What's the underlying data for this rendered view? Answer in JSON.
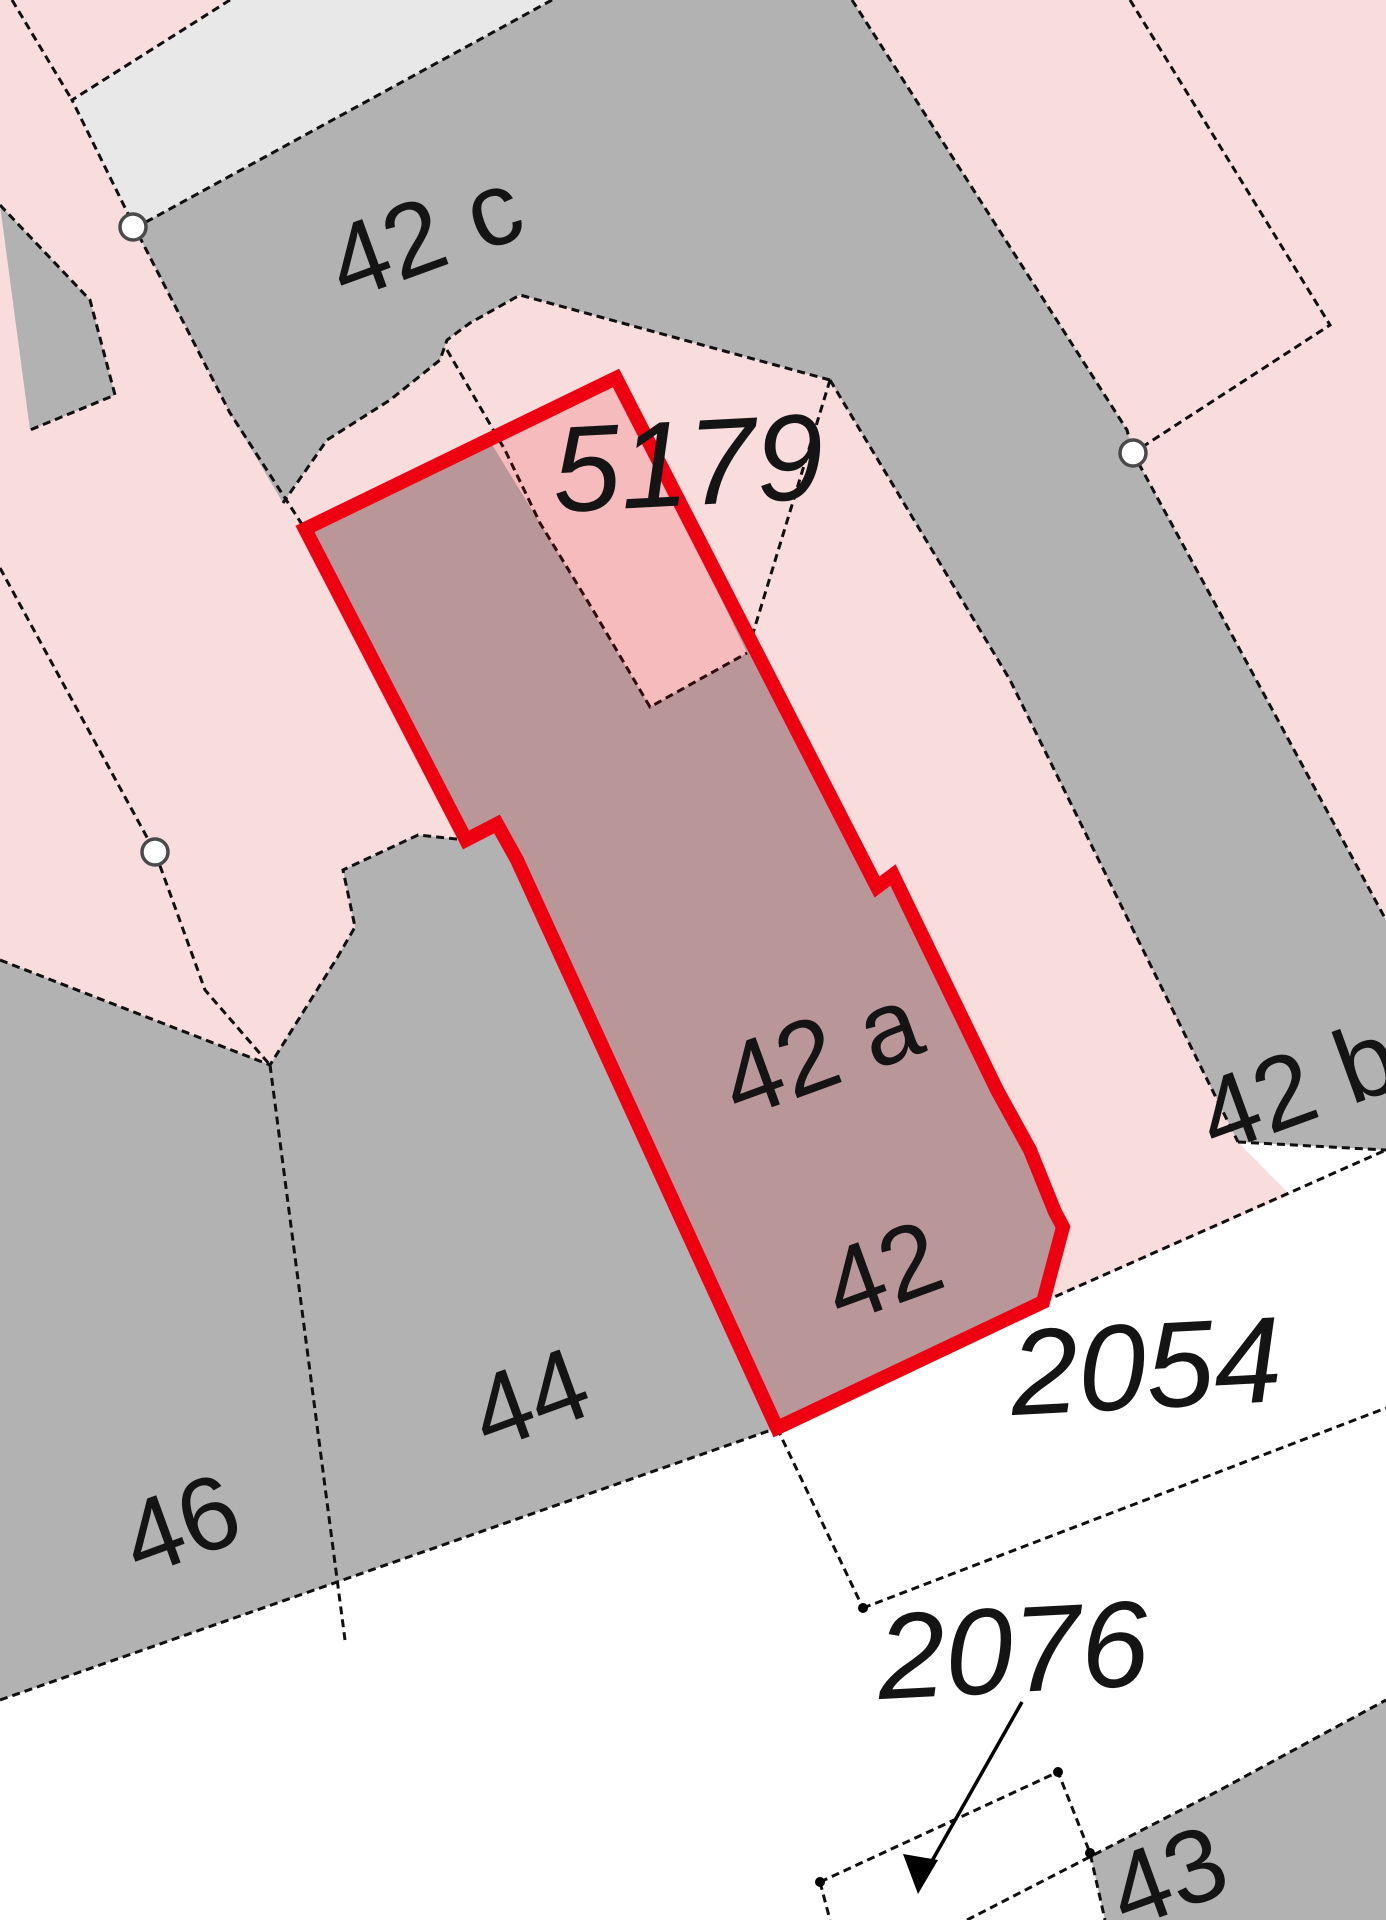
{
  "map": {
    "description": "cadastral parcel map with highlighted parcel",
    "colors": {
      "parcel_pink": "#f9dcdc",
      "building_gray": "#b2b2b2",
      "street_white": "#ffffff",
      "light_gray_area": "#e8e8e8",
      "highlight_red_stroke": "#ee0011",
      "highlight_red_fill": "rgba(230,0,15,0.15)",
      "boundary_black": "#101010"
    },
    "highlight": {
      "house_labels_inside": [
        "42 a",
        "42"
      ],
      "selected": true
    }
  },
  "labels": [
    {
      "id": "house-42c",
      "text": "42 c"
    },
    {
      "id": "parcel-5179",
      "text": "5179"
    },
    {
      "id": "house-42a",
      "text": "42 a"
    },
    {
      "id": "house-42",
      "text": "42"
    },
    {
      "id": "house-42b",
      "text": "42 b"
    },
    {
      "id": "house-44",
      "text": "44"
    },
    {
      "id": "house-46",
      "text": "46"
    },
    {
      "id": "parcel-2054",
      "text": "2054"
    },
    {
      "id": "parcel-2076",
      "text": "2076"
    },
    {
      "id": "house-43",
      "text": "43"
    }
  ],
  "boundary_circles": [
    {
      "x": 133,
      "y": 227
    },
    {
      "x": 155,
      "y": 852
    },
    {
      "x": 1133,
      "y": 453
    }
  ],
  "junction_dots": [
    {
      "x": 863,
      "y": 1608
    },
    {
      "x": 820,
      "y": 1882
    },
    {
      "x": 1058,
      "y": 1772
    },
    {
      "x": 1090,
      "y": 1853
    }
  ]
}
